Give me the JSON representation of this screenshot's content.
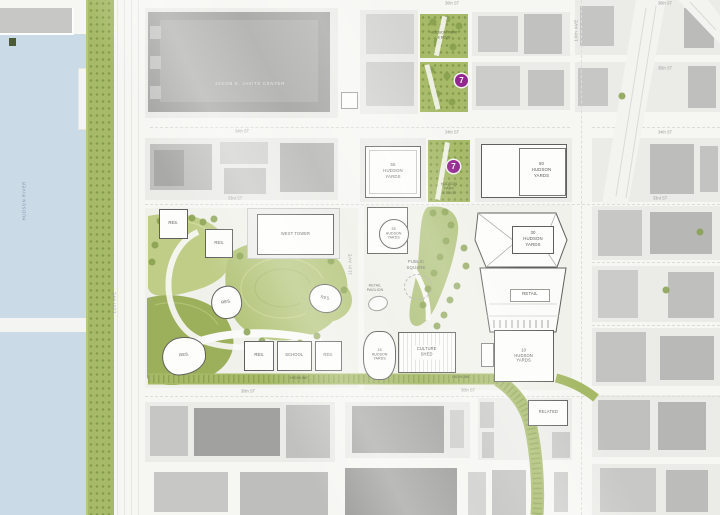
{
  "labels": {
    "water": "HUDSON RIVER",
    "javits": "JACOB K. JAVITS CENTER",
    "hudson_park_blvd": "HUDSON PARK\n& BLVD",
    "hy55": "55\nHUDSON\nYARDS",
    "hy50": "50\nHUDSON\nYARDS",
    "hy35": "35\nHUDSON\nYARDS",
    "hy30": "30\nHUDSON\nYARDS",
    "hy15": "15\nHUDSON\nYARDS",
    "hy10": "10\nHUDSON\nYARDS",
    "west_tower": "WEST TOWER",
    "res": "RES.",
    "school": "SCHOOL",
    "culture_shed": "CULTURE\nSHED",
    "retail": "RETAIL",
    "retail_pavilion": "RETAIL\nPAVILION",
    "public_square": "PUBLIC\nSQUARE",
    "related": "RELATED",
    "highline": "HIGHLINE"
  },
  "streets": {
    "s36_mid": "36th ST",
    "s36_east": "36th ST",
    "s35_east": "35th ST",
    "s34_west": "34th ST",
    "s34_mid": "34th ST",
    "s34_east": "34th ST",
    "s33_west": "33rd ST",
    "s33_east": "33rd ST",
    "s30_west": "30th ST",
    "s30_mid": "30th ST",
    "ave10": "10th AVE",
    "ave11": "11th AVE",
    "ave12": "12th AVE"
  },
  "transit": {
    "subway_line": "7",
    "subway_color": "#92278f"
  },
  "colors": {
    "water": "#cbdae7",
    "park_green": "#a6ba68",
    "landscape_light": "#bfcd87",
    "landscape_mid": "#b4c57a",
    "landscape_dark": "#9cb05c",
    "highline_green": "#a5b967",
    "building_gray": "#a2a2a0",
    "site_white": "#fdfdfb",
    "subway_purple": "#92278f"
  }
}
